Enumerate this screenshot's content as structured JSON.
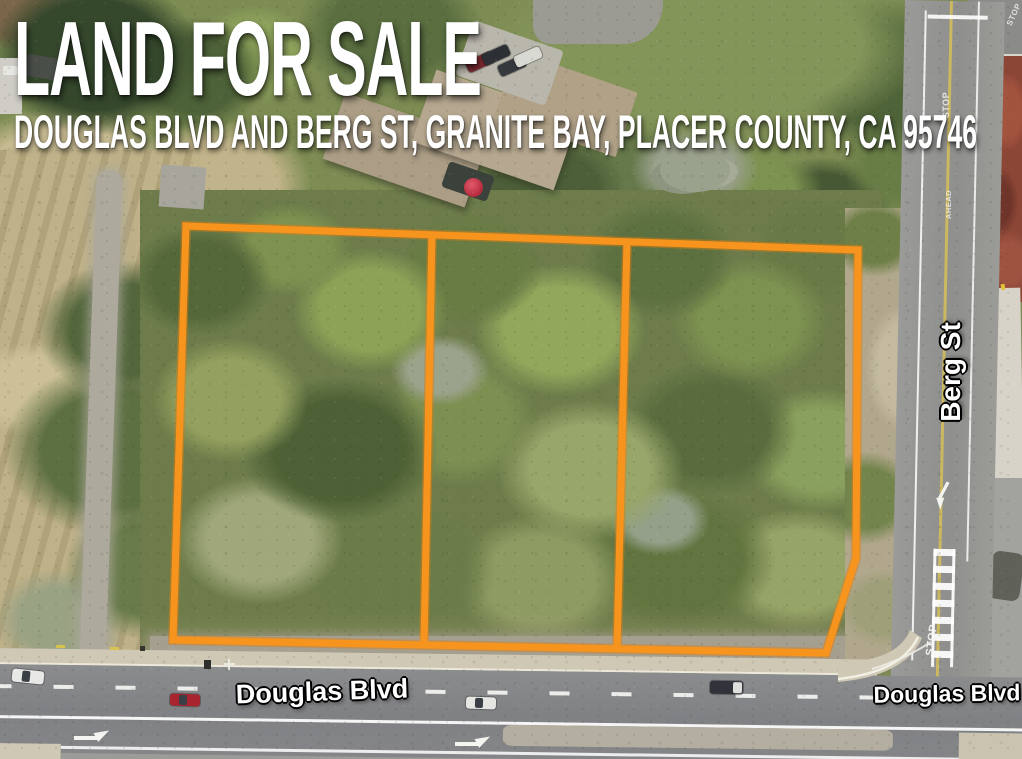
{
  "header": {
    "title": "LAND FOR SALE",
    "subtitle": "DOUGLAS BLVD AND BERG ST, GRANITE BAY, PLACER COUNTY, CA 95746"
  },
  "map": {
    "street_labels": {
      "berg_st": "Berg St",
      "douglas_blvd_west": "Douglas Blvd",
      "douglas_blvd_east": "Douglas Blvd"
    },
    "road_markings": {
      "stop": "STOP",
      "ahead": "AHEAD"
    },
    "parcel": {
      "outline_color": "#F7941E",
      "lot_count": 3
    }
  }
}
